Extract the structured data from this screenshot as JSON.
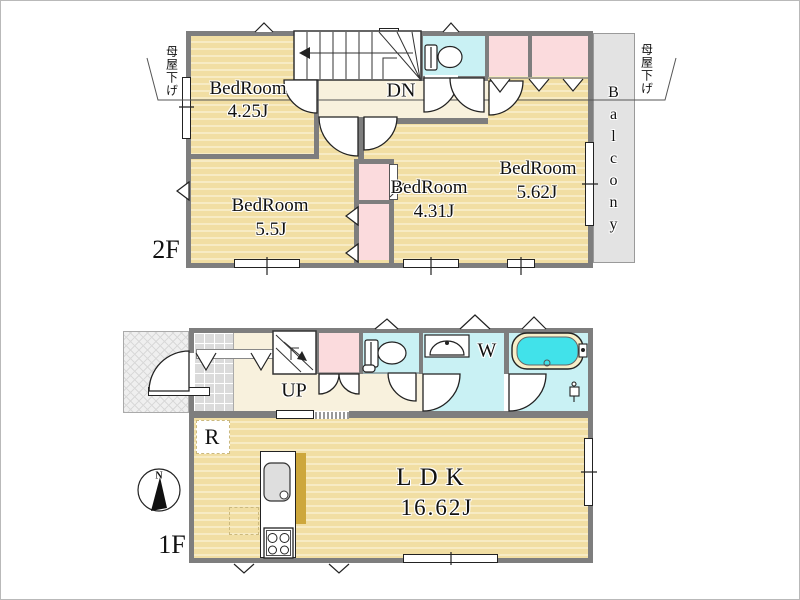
{
  "floor2": {
    "label": "2F",
    "rooms": [
      {
        "name": "BedRoom",
        "size": "4.25J"
      },
      {
        "name": "BedRoom",
        "size": "5.5J"
      },
      {
        "name": "BedRoom",
        "size": "4.31J"
      },
      {
        "name": "BedRoom",
        "size": "5.62J"
      }
    ],
    "stairs": "DN",
    "balcony": "Balcony",
    "roof_note_left": "母屋下げ",
    "roof_note_right": "母屋下げ"
  },
  "floor1": {
    "label": "1F",
    "stairs": "UP",
    "room": {
      "name": "LDK",
      "size": "16.62J"
    },
    "washer": "W",
    "refrigerator": "R",
    "compass_north": "N"
  },
  "colors": {
    "room_fill": "#F1DEA3",
    "hall_fill": "#F8F1DD",
    "wet_area_fill": "#C9F1F4",
    "closet_fill": "#FBDBDD",
    "bathtub_fill": "#41E2EA",
    "wall": "#7E7E7E",
    "balcony_fill": "#E3E3E3",
    "counter_accent": "#CDA73C"
  }
}
